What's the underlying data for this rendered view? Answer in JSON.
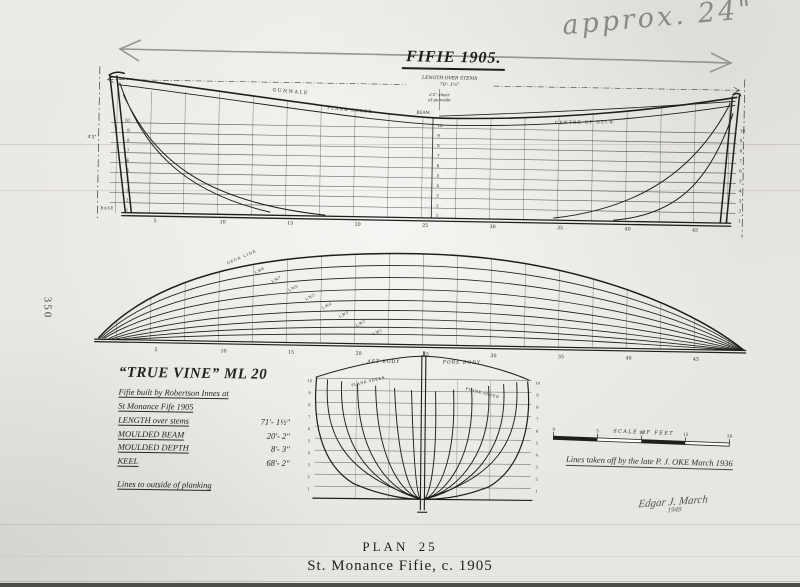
{
  "page": {
    "side_number": "350",
    "caption_plan": "PLAN 25",
    "caption_title": "St. Monance Fifie, c. 1905"
  },
  "pencil": {
    "note": "approx. 24\""
  },
  "title": "FIFIE  1905.",
  "sheer": {
    "length_label": "LENGTH OVER STEMS",
    "length_value": "70'- 1½\"",
    "sheer_note_1": "2'2\" sheer",
    "sheer_note_2": "of gunwale",
    "gunwale": "GUNWALE",
    "plank_sheer": "PLANK SHEER",
    "beam": "BEAM",
    "centre_of_deck": "CENTRE OF DECK",
    "base": "BASE",
    "margin_dim": "4'5\"",
    "waterlines": [
      "10",
      "9",
      "8",
      "7",
      "6",
      "5",
      "4",
      "3",
      "2",
      "1"
    ],
    "stations": [
      "5",
      "10",
      "15",
      "20",
      "25",
      "30",
      "35",
      "40",
      "45"
    ]
  },
  "half": {
    "deck_line": "DECK LINE",
    "lwl_labels": [
      "L.W.8",
      "L.W.7",
      "L.W.6",
      "L.W.5",
      "L.W.4",
      "L.W.3",
      "L.W.2",
      "L.W.1"
    ]
  },
  "body": {
    "aft_label": "AFT BODY",
    "fore_label": "FORE BODY",
    "plank_sheer_left": "PLANK SHEER",
    "plank_sheer_right": "PLANK SHEER"
  },
  "block": {
    "name": "“TRUE VINE” ML 20",
    "line1": "Fifie built by Robertson Innes at",
    "line2": "St Monance Fife  1905",
    "specs": [
      {
        "label": "LENGTH over stems",
        "value": "71'- 1½\""
      },
      {
        "label": "MOULDED BEAM",
        "value": "20'- 2\""
      },
      {
        "label": "MOULDED DEPTH",
        "value": "8'- 3\""
      },
      {
        "label": "KEEL",
        "value": "68'- 2\""
      }
    ],
    "note": "Lines to outside of planking"
  },
  "scale": {
    "label": "SCALE OF FEET",
    "ticks": [
      "0",
      "5",
      "10",
      "15",
      "20"
    ]
  },
  "credit": "Lines taken off by the late P. J. OKE   March 1936",
  "signature": {
    "name": "Edgar J. March",
    "year": "1949"
  }
}
